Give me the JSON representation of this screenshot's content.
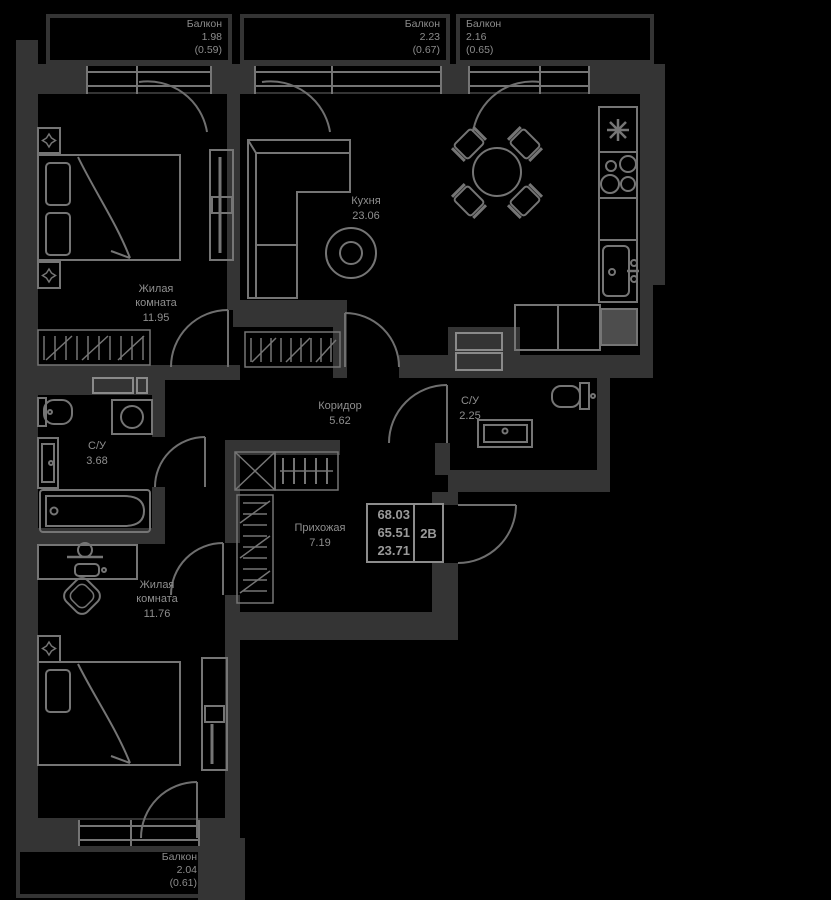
{
  "rooms": {
    "living1": {
      "name": "Жилая комната",
      "area": "11.95"
    },
    "kitchen": {
      "name": "Кухня",
      "area": "23.06"
    },
    "corridor": {
      "name": "Коридор",
      "area": "5.62"
    },
    "bathroom_small": {
      "name": "С/У",
      "area": "2.25"
    },
    "bathroom_large": {
      "name": "С/У",
      "area": "3.68"
    },
    "hallway": {
      "name": "Прихожая",
      "area": "7.19"
    },
    "living2": {
      "name": "Жилая комната",
      "area": "11.76"
    }
  },
  "balconies": {
    "top_left": {
      "name": "Балкон",
      "area": "1.98",
      "reduced": "(0.59)"
    },
    "top_middle": {
      "name": "Балкон",
      "area": "2.23",
      "reduced": "(0.67)"
    },
    "top_right": {
      "name": "Балкон",
      "area": "2.16",
      "reduced": "(0.65)"
    },
    "bottom": {
      "name": "Балкон",
      "area": "2.04",
      "reduced": "(0.61)"
    }
  },
  "info_box": {
    "total_area": "68.03",
    "living_plus_area": "65.51",
    "rooms_area": "23.71",
    "flat_type": "2В"
  },
  "colors": {
    "background": "#000000",
    "wall": "#343434",
    "furniture_line": "#757575",
    "door_line": "#6f6f6f",
    "label_text": "#8f8f8f",
    "info_border": "#8c8c8c",
    "appliance_fill": "#4d4d4d"
  }
}
